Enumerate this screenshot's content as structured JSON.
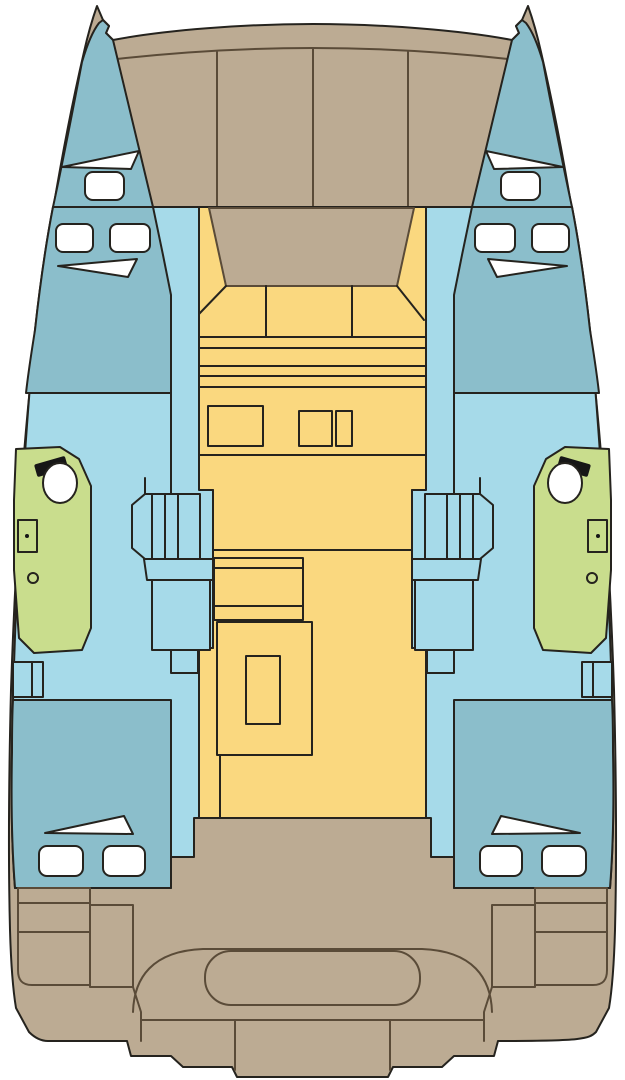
{
  "diagram": {
    "kind": "catamaran-deck-plan",
    "regions": [
      {
        "name": "foredeck",
        "color_key": "hull_tan"
      },
      {
        "name": "port-bow-cabin",
        "color_key": "cabin_blue"
      },
      {
        "name": "starboard-bow-cabin",
        "color_key": "cabin_blue"
      },
      {
        "name": "port-hull-passage",
        "color_key": "hull_blue"
      },
      {
        "name": "starboard-hull-passage",
        "color_key": "hull_blue"
      },
      {
        "name": "port-head-compartment",
        "color_key": "head_green"
      },
      {
        "name": "starboard-head-compartment",
        "color_key": "head_green"
      },
      {
        "name": "salon",
        "color_key": "salon_yellow"
      },
      {
        "name": "port-aft-cabin",
        "color_key": "cabin_blue"
      },
      {
        "name": "starboard-aft-cabin",
        "color_key": "cabin_blue"
      },
      {
        "name": "aft-cockpit",
        "color_key": "hull_tan"
      },
      {
        "name": "stern-bench",
        "color_key": "hull_tan"
      },
      {
        "name": "transom-steps",
        "color_key": "hull_tan"
      }
    ]
  },
  "palette": {
    "background": "#ffffff",
    "hull_tan": "#bcab93",
    "salon_yellow": "#fad87f",
    "hull_blue": "#a6dae9",
    "cabin_blue": "#8bbecb",
    "head_green": "#c9dd8d",
    "fixture_white": "#ffffff",
    "fixture_black": "#161616",
    "outline": "#25231e",
    "deck_line": "#5a4b38"
  }
}
